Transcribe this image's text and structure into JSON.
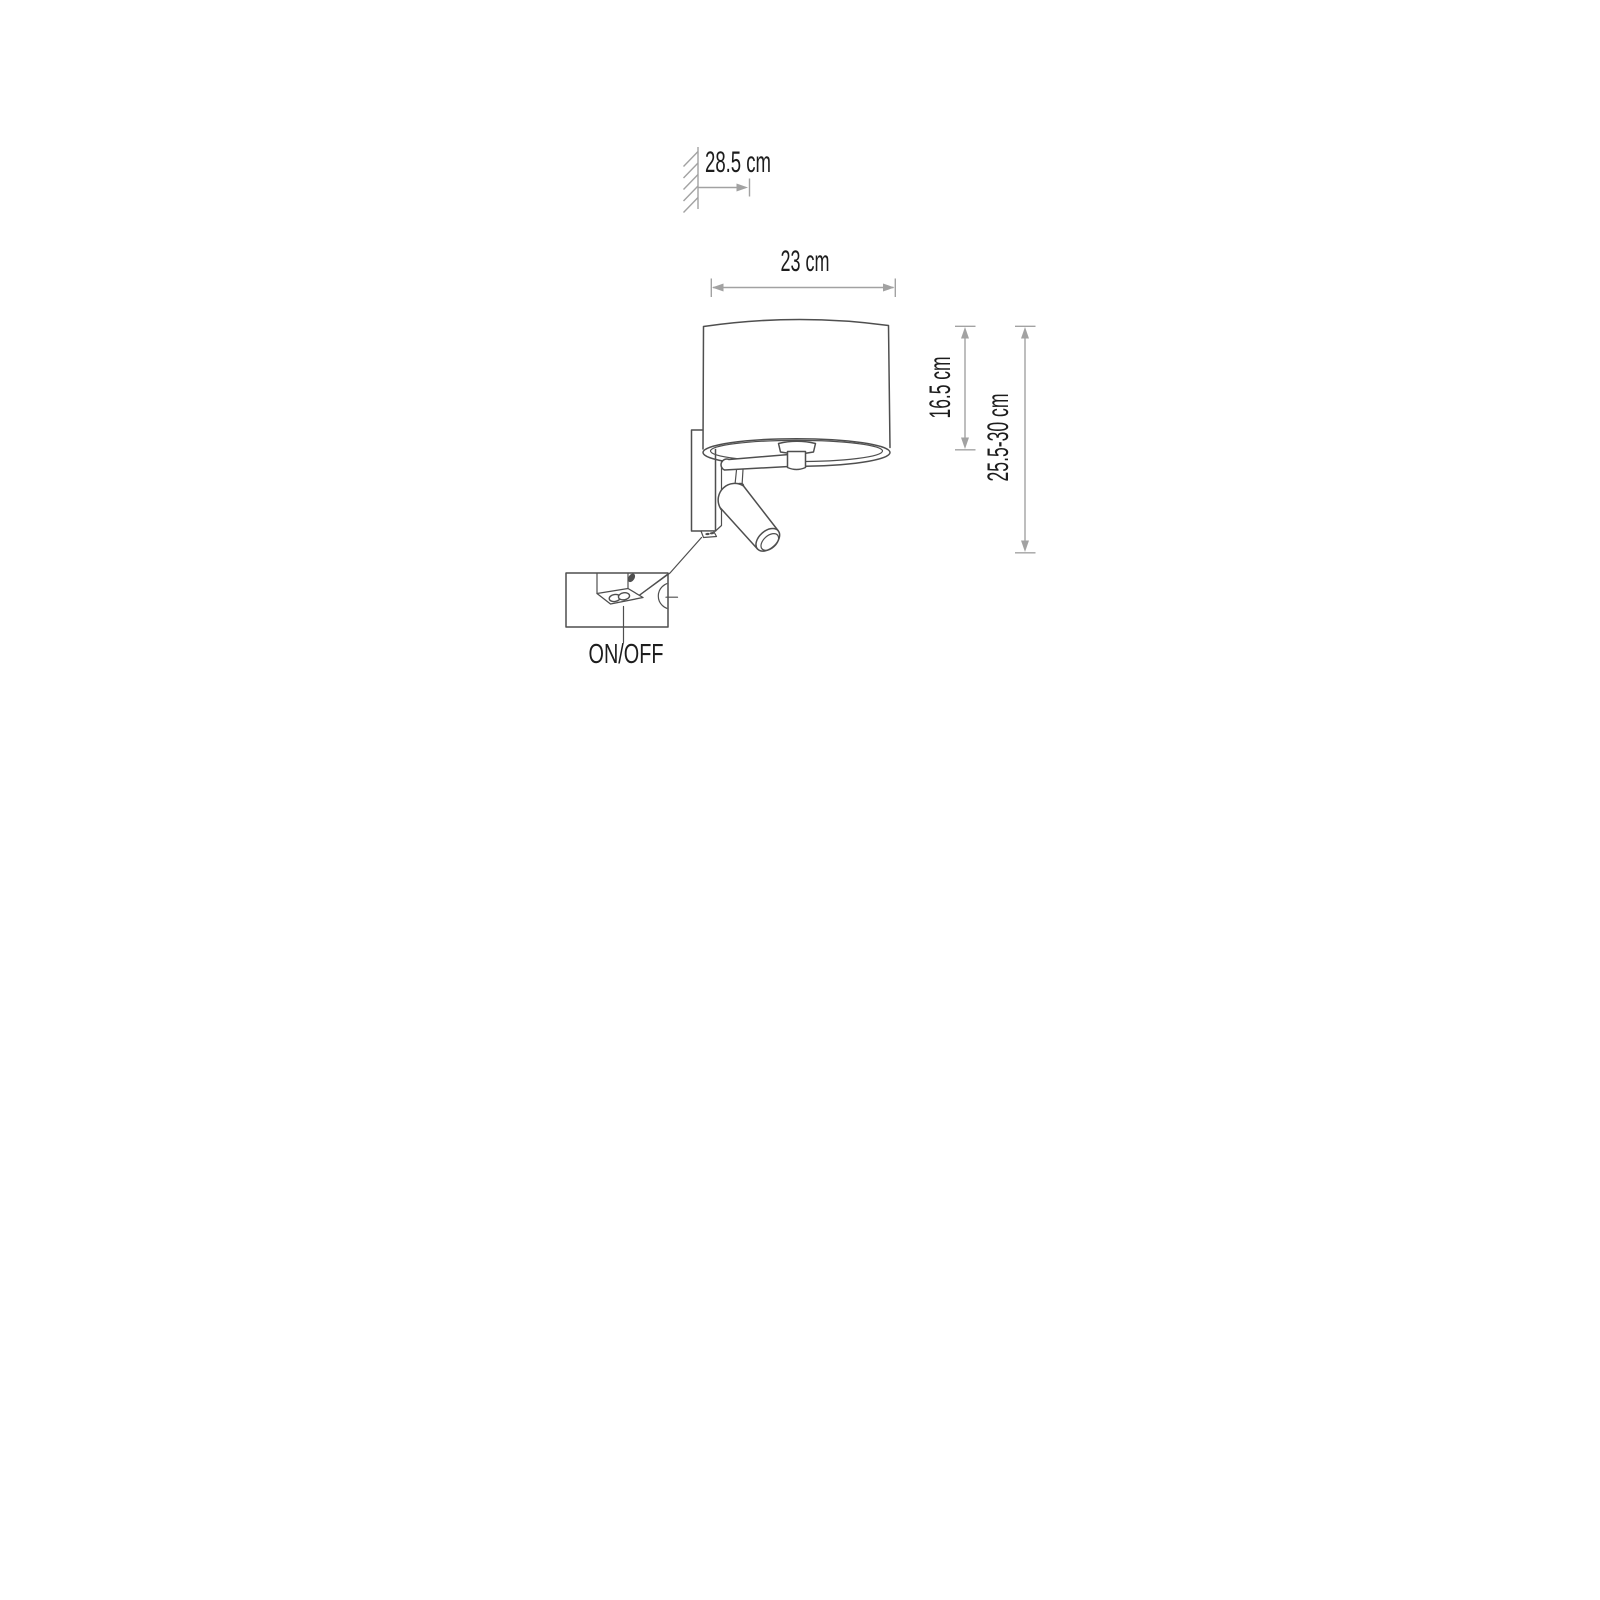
{
  "diagram": {
    "type": "product-dimension-drawing",
    "subject": "wall-lamp-with-reading-spotlight",
    "labels": {
      "wall_distance": "28.5 cm",
      "shade_width": "23 cm",
      "shade_height": "16.5 cm",
      "total_height": "25.5-30 cm",
      "switch": "ON/OFF"
    },
    "colors": {
      "background": "#ffffff",
      "drawing_line": "#4f4f4f",
      "dimension_line": "#a2a2a2",
      "text": "#1d1d1d"
    }
  }
}
